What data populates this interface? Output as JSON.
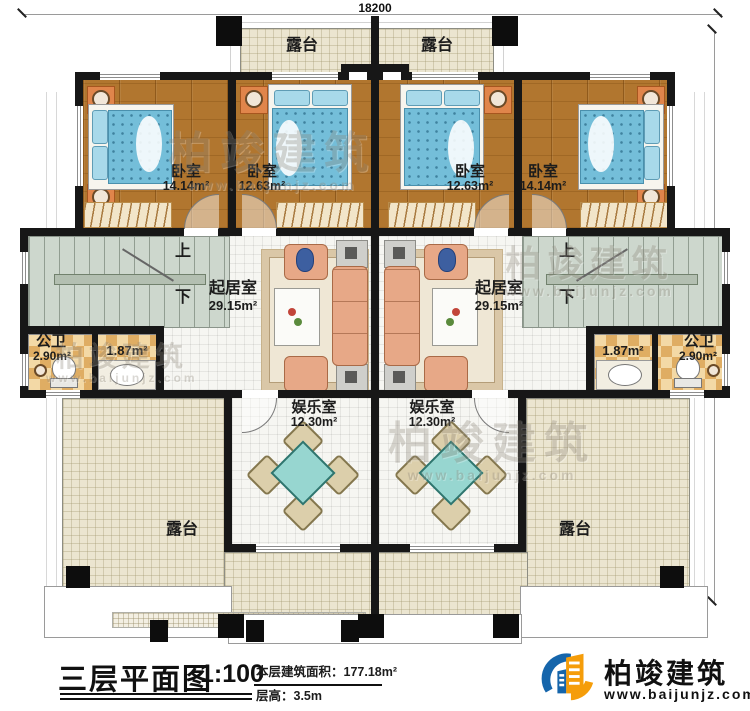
{
  "dimensions": {
    "top": "18200",
    "right": "15840"
  },
  "rooms": {
    "terrace_top_left": {
      "name": "露台"
    },
    "terrace_top_right": {
      "name": "露台"
    },
    "bedroom_1": {
      "name": "卧室",
      "area": "14.14m²"
    },
    "bedroom_2": {
      "name": "卧室",
      "area": "12.63m²"
    },
    "bedroom_3": {
      "name": "卧室",
      "area": "12.63m²"
    },
    "bedroom_4": {
      "name": "卧室",
      "area": "14.14m²"
    },
    "living_left": {
      "name": "起居室",
      "area": "29.15m²"
    },
    "living_right": {
      "name": "起居室",
      "area": "29.15m²"
    },
    "stair_left": {
      "up": "上",
      "down": "下"
    },
    "stair_right": {
      "up": "上",
      "down": "下"
    },
    "bath_left": {
      "name": "公卫",
      "area": "2.90m²",
      "area2": "1.87m²"
    },
    "bath_right": {
      "name": "公卫",
      "area": "2.90m²",
      "area2": "1.87m²"
    },
    "ent_left": {
      "name": "娱乐室",
      "area": "12.30m²"
    },
    "ent_right": {
      "name": "娱乐室",
      "area": "12.30m²"
    },
    "terrace_bottom_left": {
      "name": "露台"
    },
    "terrace_bottom_right": {
      "name": "露台"
    }
  },
  "title_block": {
    "title": "三层平面图",
    "scale": "1:100",
    "area_label": "本层建筑面积：177.18m²",
    "floor_height": "层高：3.5m"
  },
  "logo": {
    "name": "柏竣建筑",
    "url": "www.baijunjz.com"
  },
  "watermark": {
    "text": "柏竣建筑",
    "sub": "www.baijunjz.com"
  },
  "colors": {
    "wall": "#171717",
    "wood_floor": "#b1762f",
    "terrace_tile": "#ebe5d0",
    "stair": "#cdd7cd",
    "bath_tile": "#e8bd77",
    "bed": "#74bed9",
    "sofa": "#e7a887",
    "game_table": "#97d6d0",
    "logo_blue": "#1565ab",
    "logo_orange": "#f59d0a"
  }
}
